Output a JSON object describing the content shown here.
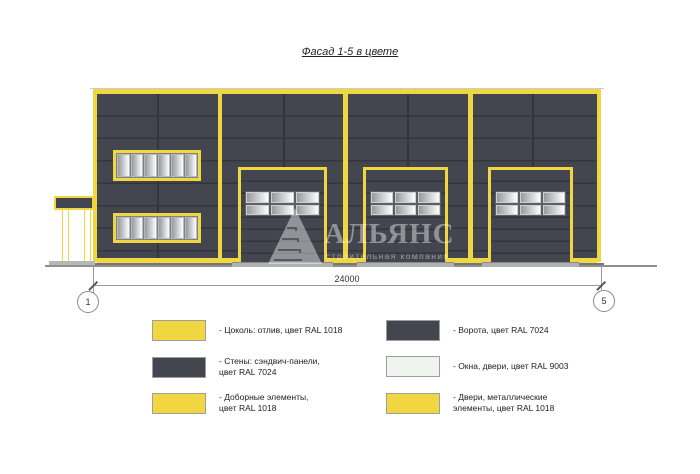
{
  "title": "Фасад 1-5 в цвете",
  "drawing": {
    "dimension_label": "24000",
    "axis_left": "1",
    "axis_right": "5"
  },
  "watermark": {
    "name": "АЛЬЯНС",
    "subtitle": "строительная компания"
  },
  "colors": {
    "wall": "#43464E",
    "seam": "#31353D",
    "trim": "#F0D640",
    "glass-a": "#97999D",
    "glass-b": "#FEFEFE",
    "ral9003": "#F0F4EF",
    "threshold": "#AEB0B1",
    "line": "#8E8E8E"
  },
  "legend": {
    "items": [
      {
        "swatch": "#F0D640",
        "label": "- Цоколь: отлив, цвет RAL 1018"
      },
      {
        "swatch": "#43464E",
        "label": "- Стены: сэндвич-панели,\nцвет RAL 7024"
      },
      {
        "swatch": "#F0D640",
        "label": "- Доборные элементы,\nцвет RAL 1018"
      },
      {
        "swatch": "#43464E",
        "label": "- Ворота, цвет RAL 7024"
      },
      {
        "swatch": "#F0F4EF",
        "label": "- Окна, двери, цвет RAL 9003"
      },
      {
        "swatch": "#F0D640",
        "label": "- Двери, металлические\nэлементы, цвет RAL 1018"
      }
    ]
  }
}
